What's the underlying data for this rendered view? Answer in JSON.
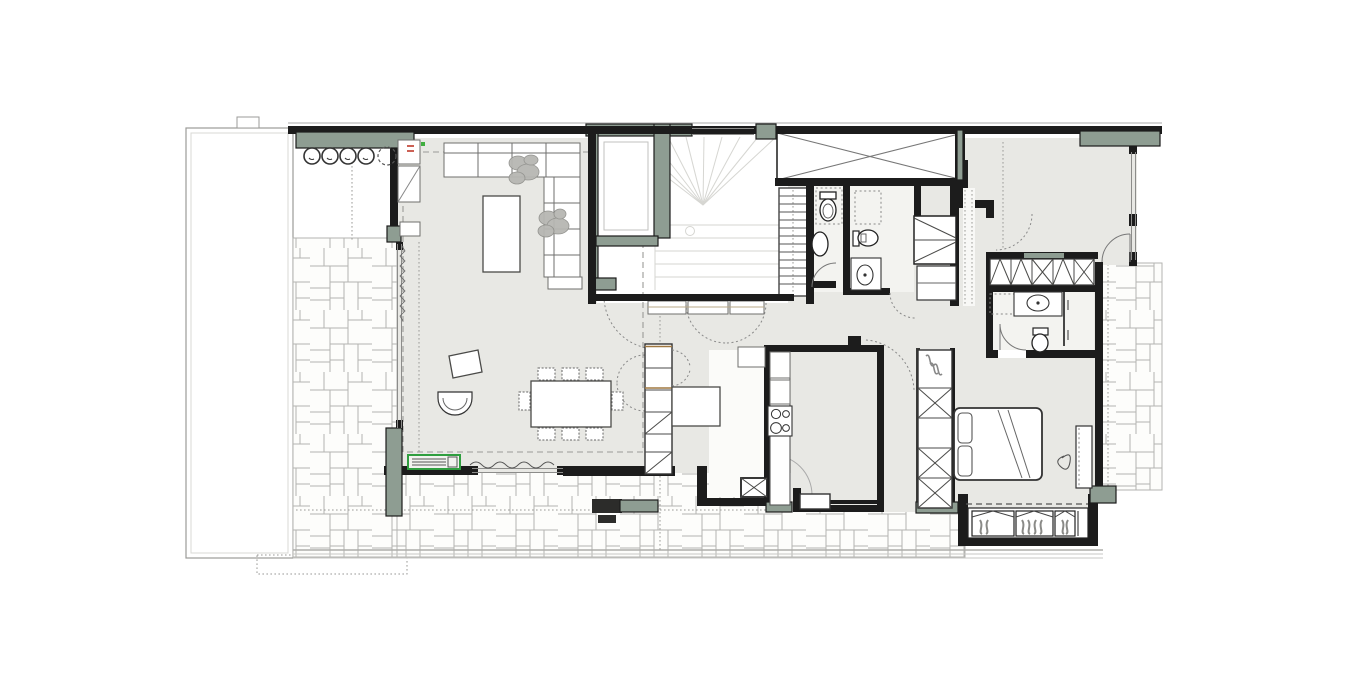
{
  "meta": {
    "title": "Apartment floor plan",
    "drawing_type": "architectural-floor-plan",
    "canvas": {
      "width": 1350,
      "height": 700
    },
    "visible_text": ""
  },
  "palette": {
    "wall": "#1c1c1c",
    "sage": "#8e9d92",
    "floor": "#e8e8e4",
    "bath": "#f3f3f0",
    "faint": "#d6d6d2",
    "bench": "#2f9e3f",
    "red": "#c03a2b",
    "green": "#3fae3f",
    "paveline": "#a5a5a2"
  },
  "inventory": {
    "terraces": [
      {
        "name": "west-terrace",
        "finish": "plain",
        "features": [
          "planter-box",
          "round-pots"
        ]
      },
      {
        "name": "south-terrace",
        "finish": "flagstone-paving",
        "features": [
          "garden-bench"
        ]
      },
      {
        "name": "east-terrace",
        "finish": "flagstone-paving",
        "features": []
      }
    ],
    "rooms": [
      {
        "name": "living-room",
        "furniture": [
          "l-shaped-sofa",
          "coffee-table",
          "plants",
          "wall-cabinets"
        ]
      },
      {
        "name": "dining-area",
        "furniture": [
          "dining-table",
          "chairs",
          "armchair",
          "side-table",
          "shelf-column",
          "desk"
        ]
      },
      {
        "name": "stair-hall",
        "furniture": [
          "elevator",
          "fan-staircase",
          "secondary-stair",
          "step-cabinets"
        ]
      },
      {
        "name": "shaft-void",
        "furniture": [
          "cross-marked-void"
        ]
      },
      {
        "name": "bathroom-1",
        "furniture": [
          "toilet",
          "washbasin",
          "shower-dashed"
        ]
      },
      {
        "name": "bathroom-2",
        "furniture": [
          "wall-hung-toilet",
          "vanity-sink",
          "shower-dashed"
        ]
      },
      {
        "name": "hall-closet",
        "furniture": [
          "diagonal-front-cabinet",
          "shelf-cabinet"
        ]
      },
      {
        "name": "kitchen",
        "furniture": [
          "counter-run",
          "cooktop",
          "appliance-door-arc",
          "utility-box"
        ]
      },
      {
        "name": "bedroom-north",
        "furniture": [
          "hidden-door-arc",
          "terrace-door"
        ]
      },
      {
        "name": "ensuite-bathroom",
        "furniture": [
          "vanity-sink",
          "toilet",
          "shower-partition",
          "wardrobe-strip"
        ]
      },
      {
        "name": "bedroom-south",
        "furniture": [
          "double-bed",
          "pillows",
          "wardrobe-column",
          "hanging-rail-cabinet",
          "bay-window-curtains",
          "side-cabinet"
        ]
      }
    ],
    "counts": {
      "terrace_pots": 4,
      "terrace_pots_dashed": 1,
      "dining_chairs": 8,
      "cooktop_burners": 4,
      "bay_window_sections": 3,
      "wardrobe_x_sections_bedroom": 4,
      "wardrobe_sections_ensuite": 5
    }
  }
}
